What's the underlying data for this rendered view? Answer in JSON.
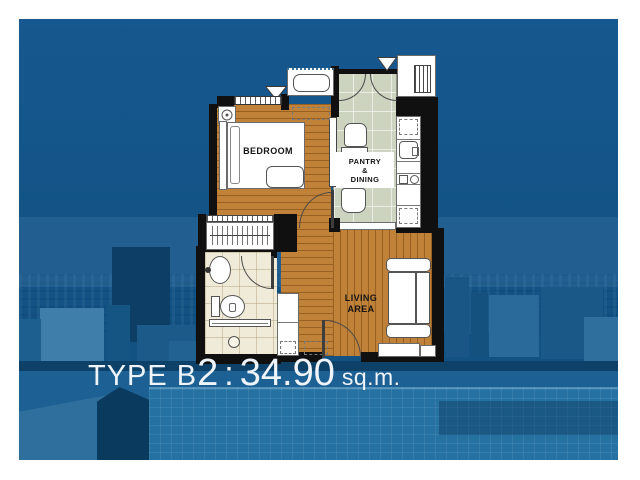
{
  "unit_label": {
    "type_prefix": "TYPE B",
    "type_number": "2",
    "colon": ":",
    "area_value": "34.90",
    "area_unit": "sq.m."
  },
  "rooms": {
    "bedroom": "BEDROOM",
    "pantry_line1": "PANTRY",
    "pantry_line2": "&",
    "pantry_line3": "DINING",
    "living_line1": "LIVING",
    "living_line2": "AREA"
  },
  "icons": {
    "window-marker-triangle": "white triangle pointing down",
    "ac-louvre": "striped vent grille",
    "wardrobe-hangers": "clothes rod with hangers",
    "flower-ornament": "ring with dot",
    "shower-drain": "small circle"
  },
  "colors": {
    "sky-top": "#16588f",
    "sky-mid": "#11517f",
    "wall": "#101010",
    "wood": "#c08138",
    "pantry-tile": "#ccd3bf",
    "bath-tile": "#f0ead8",
    "label-text": "#eef4f9",
    "building-dark": "#0d3f66",
    "building-mid": "#1d5f8f",
    "building-light": "#3f7dab",
    "pool": "#2471a2"
  }
}
